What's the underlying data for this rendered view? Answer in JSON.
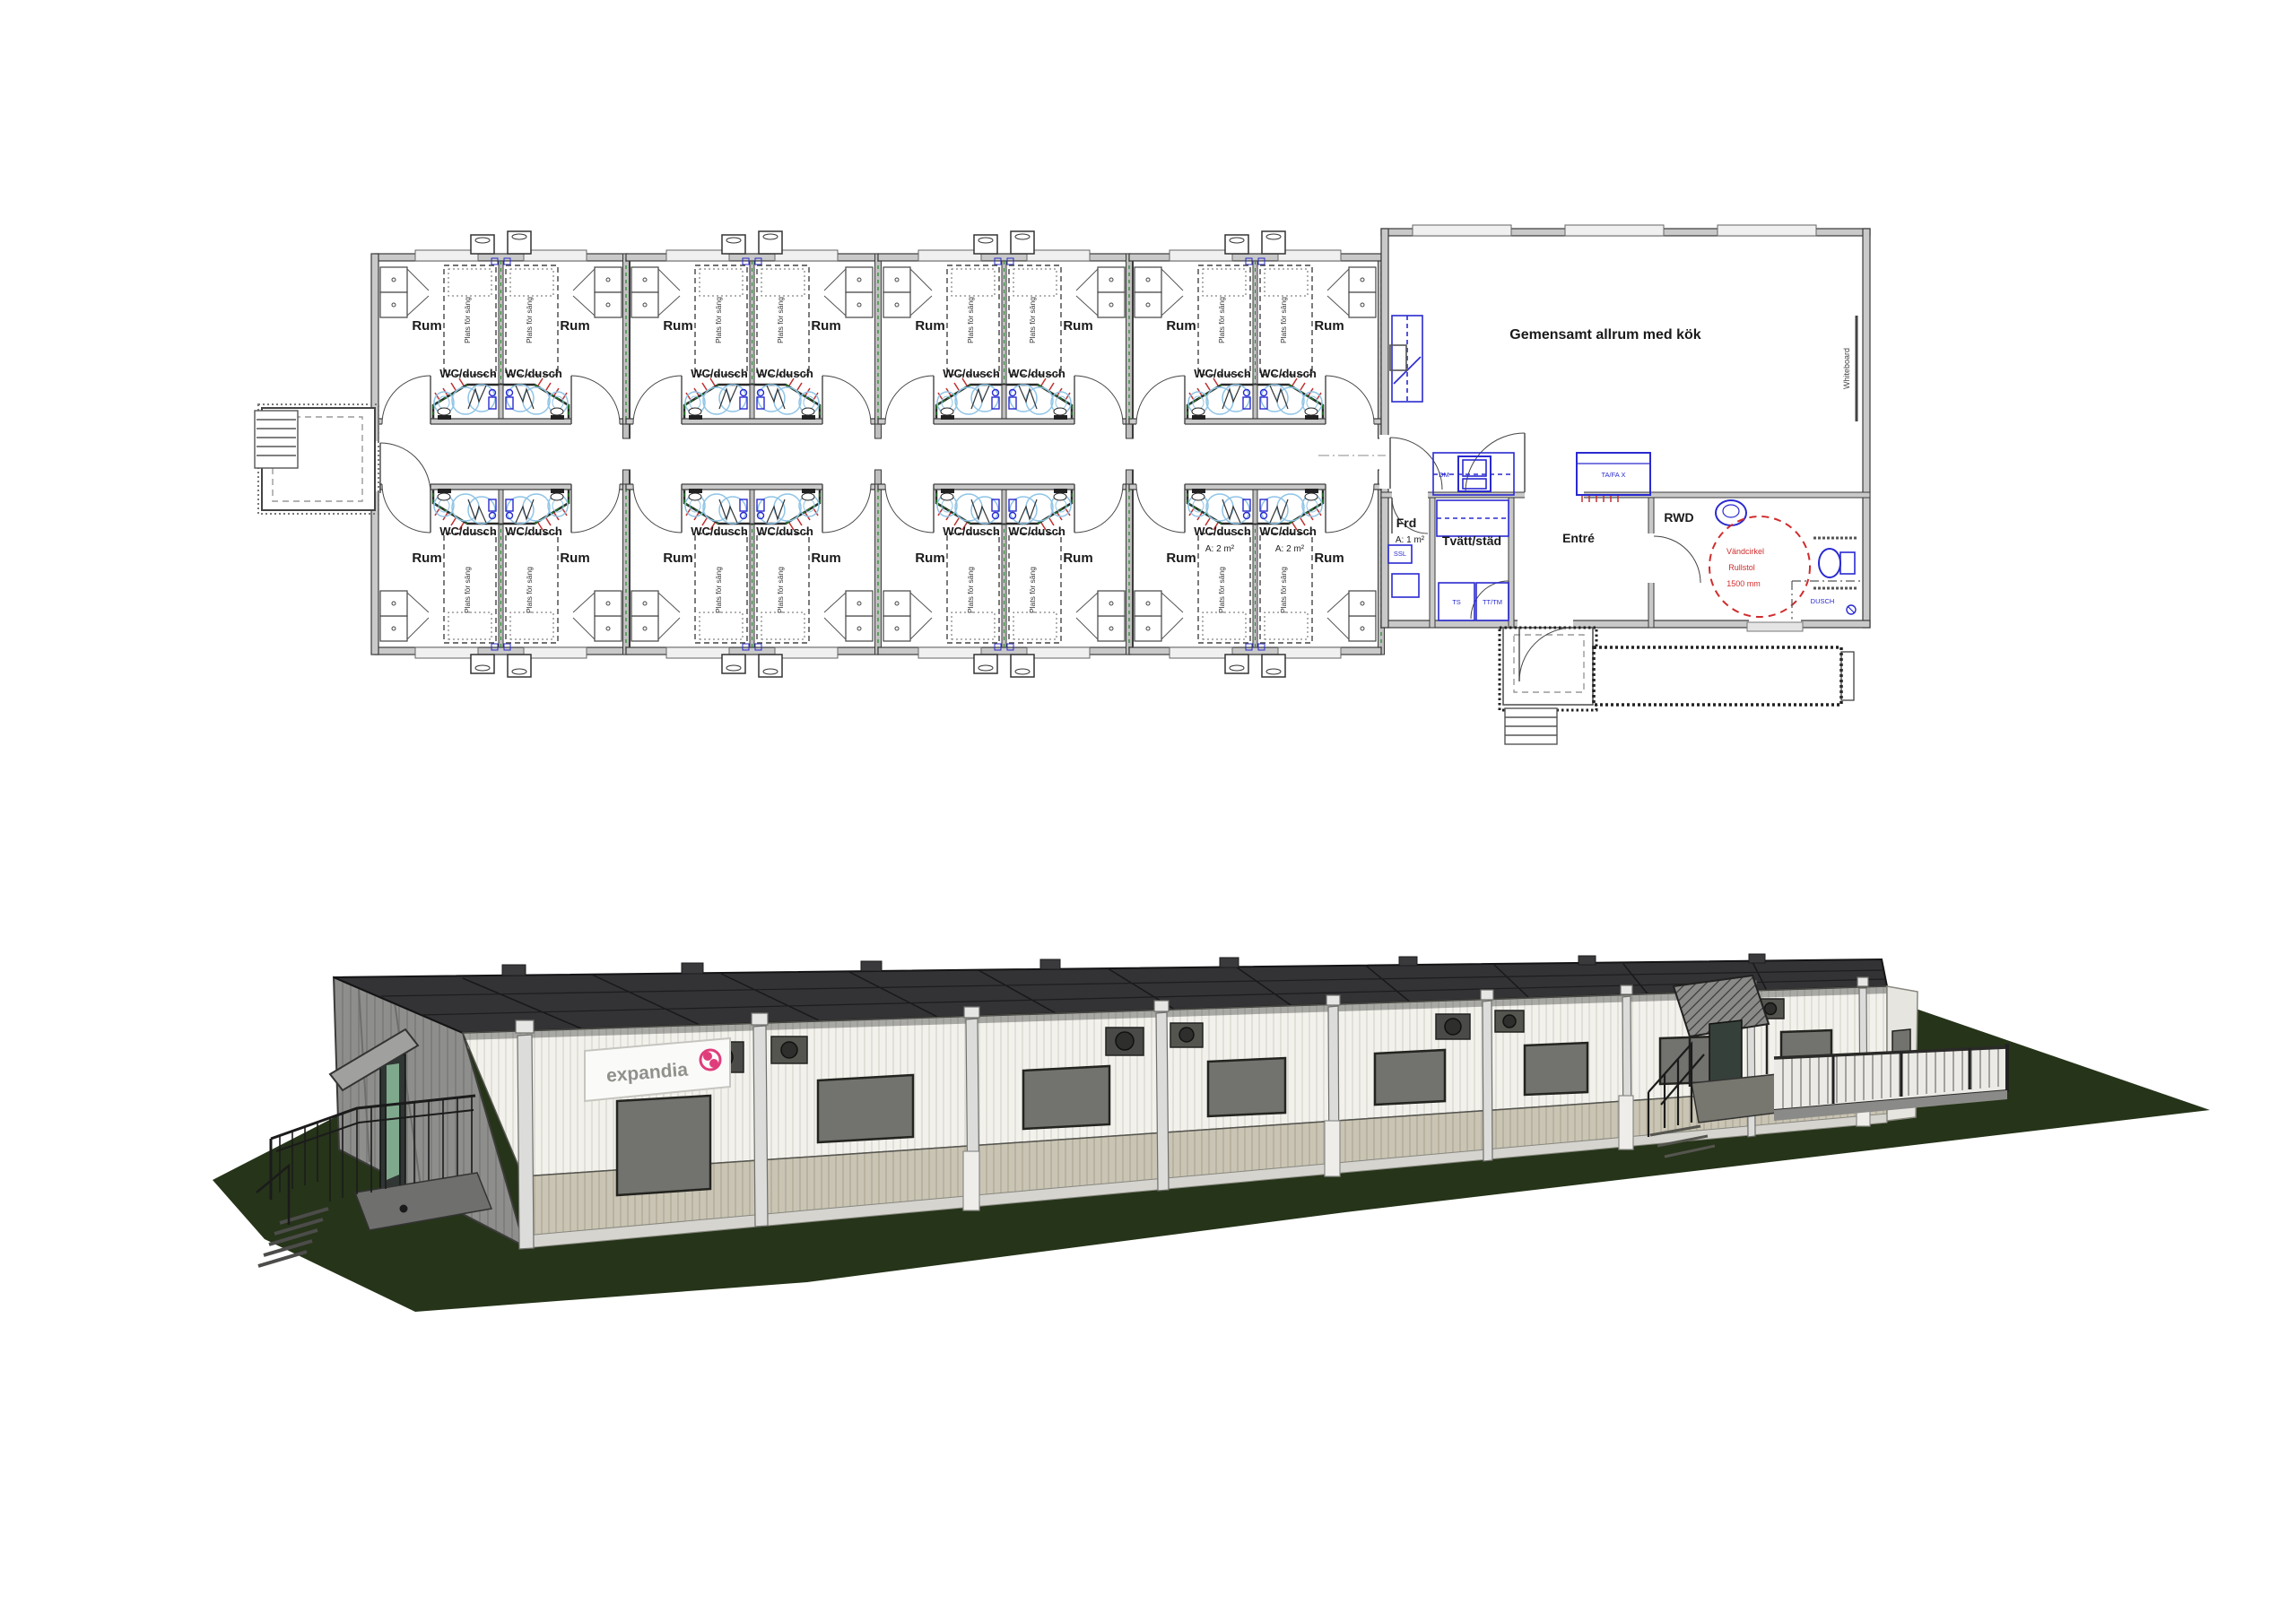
{
  "plan": {
    "room_label": "Rum",
    "wc_label": "WC/dusch",
    "bed_label": "Plats för säng",
    "wc_area_label": "A: 2 m²",
    "common_room_label": "Gemensamt allrum med kök",
    "whiteboard_label": "Whiteboard",
    "storage_label": "Frd",
    "storage_area_label": "A: 1 m²",
    "ssl_label": "SSL",
    "dm_label": "DM",
    "laundry_label": "Tvätt/städ",
    "ts_label": "TS",
    "ttm_label": "TT/TM",
    "entrance_label": "Entré",
    "tafa_label": "TA/FA X",
    "rwd_label": "RWD",
    "turn_line1": "Vändcirkel",
    "turn_line2": "Rullstol",
    "turn_line3": "1500 mm",
    "dusch_label": "DUSCH"
  },
  "render": {
    "logo_text": "expandia"
  },
  "colors": {
    "plan_blue": "#2a2ad0",
    "plan_light_blue": "#8fc4e6",
    "plan_red": "#d02c2c",
    "hatch_green": "#1e8a22",
    "wall_gray": "#c9c9c9",
    "ground_green": "#263419",
    "roof_dark": "#333335",
    "facade_white": "#f2f1ec",
    "facade_beige": "#c9c4b4",
    "logo_pink": "#e03c7c"
  }
}
